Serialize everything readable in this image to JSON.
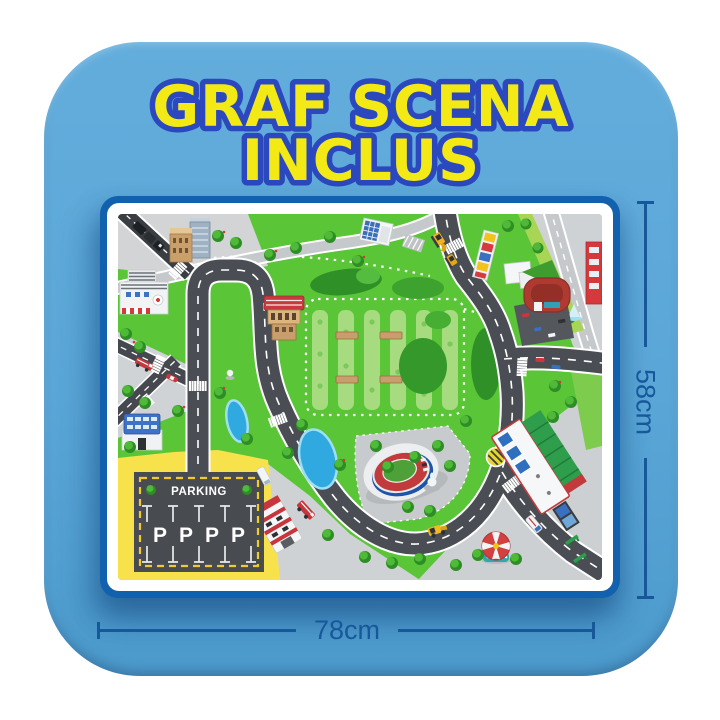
{
  "title": {
    "line1": "GRAF SCENA",
    "line2": "INCLUS"
  },
  "dimensions": {
    "width_label": "78cm",
    "height_label": "58cm"
  },
  "mat": {
    "parking_label": "PARKING",
    "parking_spots": [
      "P",
      "P",
      "P",
      "P"
    ]
  },
  "colors": {
    "page_bg": "#FFFFFF",
    "card_blue": "#5BA7D7",
    "title_yellow": "#F3EA15",
    "title_outline": "#2B48BE",
    "mat_frame_blue": "#1161AE",
    "mat_border_white": "#FFFFFF",
    "dimension_blue": "#17589B",
    "grass_green": "#5BC538",
    "road_gray": "#4A4E54",
    "parking_ground_yellow": "#F7E24B",
    "pond_blue": "#30A9E0"
  }
}
